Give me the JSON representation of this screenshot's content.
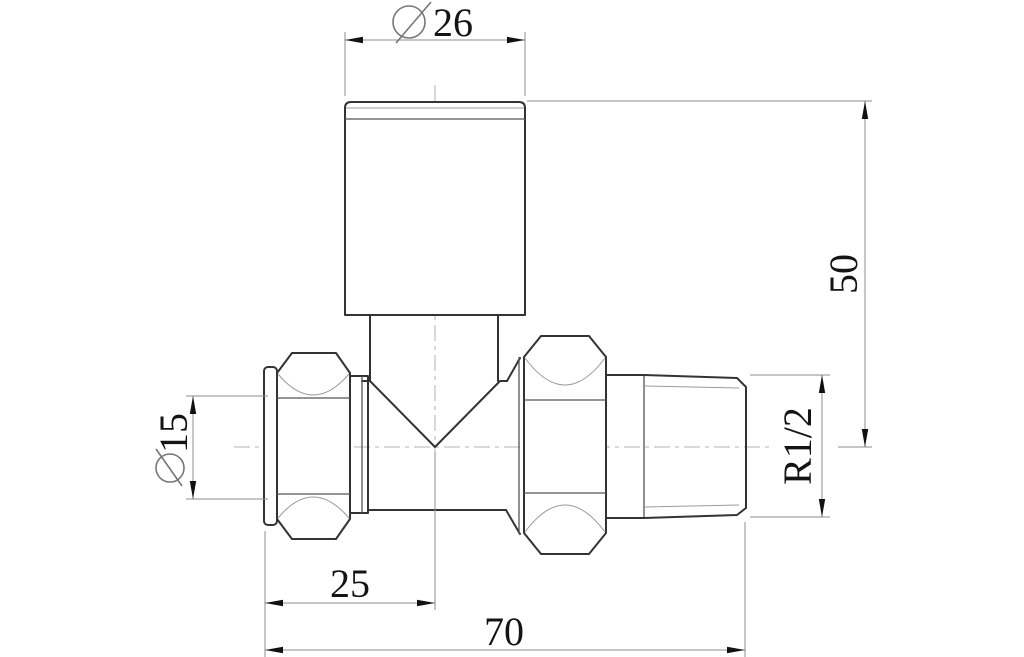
{
  "drawing": {
    "labels": {
      "cap_diameter": "26",
      "pipe_diameter": "15",
      "height_to_center": "50",
      "thread_size": "R1/2",
      "inlet_to_center": "25",
      "overall_length": "70"
    },
    "colors": {
      "outline": "#333333",
      "dimension_lines": "#8c8c8c",
      "centerline": "#b3b3b3",
      "text": "#141414",
      "background": "#ffffff"
    }
  }
}
